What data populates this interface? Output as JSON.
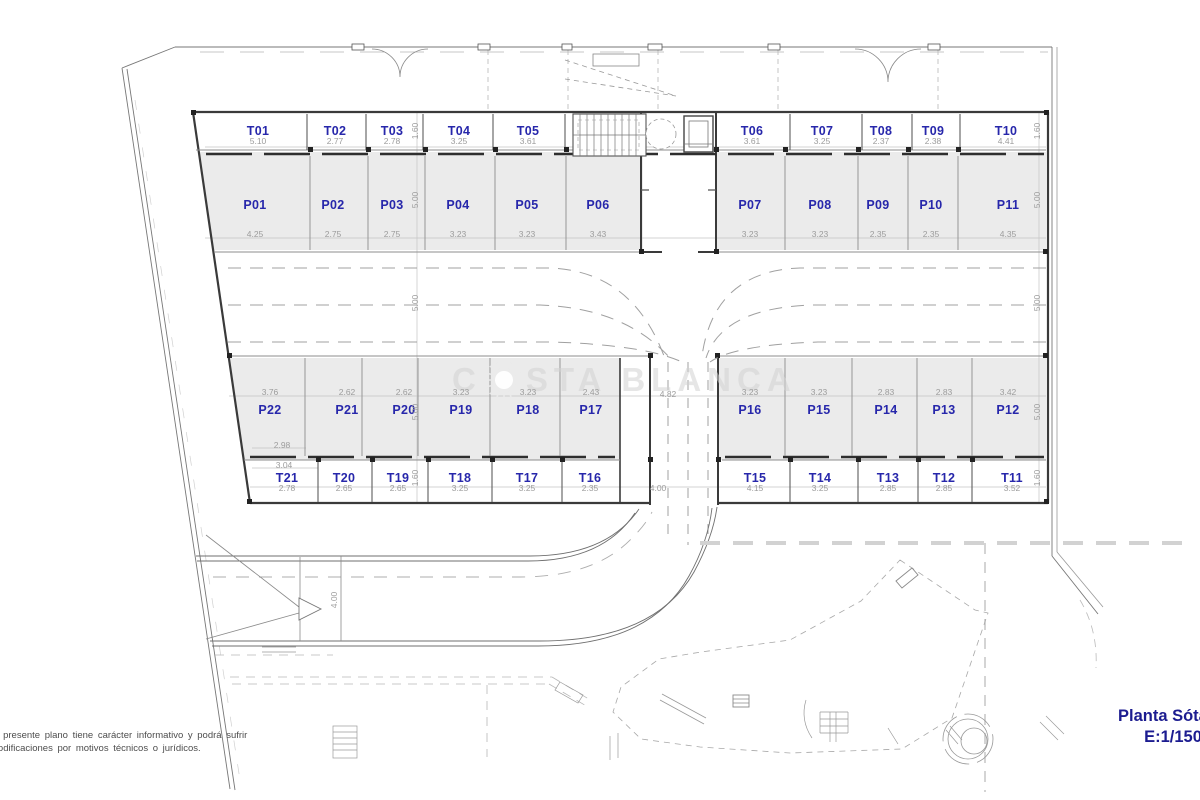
{
  "title_block": {
    "plan_title": "Planta Sótano",
    "scale": "E:1/150"
  },
  "disclaimer": {
    "line1": "El presente plano tiene carácter informativo y podrá sufrir",
    "line2": "modificaciones por motivos técnicos o jurídicos."
  },
  "watermark": {
    "prefix": "C",
    "suffix": "STA BLANCA",
    "sun_icon": "sun-logo"
  },
  "stalls": {
    "storage_top": [
      {
        "id": "T01",
        "w": "5.10"
      },
      {
        "id": "T02",
        "w": "2.77"
      },
      {
        "id": "T03",
        "w": "2.78"
      },
      {
        "id": "T04",
        "w": "3.25"
      },
      {
        "id": "T05",
        "w": "3.61"
      },
      {
        "id": "T06",
        "w": "3.61"
      },
      {
        "id": "T07",
        "w": "3.25"
      },
      {
        "id": "T08",
        "w": "2.37"
      },
      {
        "id": "T09",
        "w": "2.38"
      },
      {
        "id": "T10",
        "w": "4.41"
      }
    ],
    "parking_top": [
      {
        "id": "P01",
        "w": "4.25"
      },
      {
        "id": "P02",
        "w": "2.75"
      },
      {
        "id": "P03",
        "w": "2.75"
      },
      {
        "id": "P04",
        "w": "3.23"
      },
      {
        "id": "P05",
        "w": "3.23"
      },
      {
        "id": "P06",
        "w": "3.43"
      },
      {
        "id": "P07",
        "w": "3.23"
      },
      {
        "id": "P08",
        "w": "3.23"
      },
      {
        "id": "P09",
        "w": "2.35"
      },
      {
        "id": "P10",
        "w": "2.35"
      },
      {
        "id": "P11",
        "w": "4.35"
      }
    ],
    "parking_bottom": [
      {
        "id": "P22",
        "w": "3.76"
      },
      {
        "id": "P21",
        "w": "2.62"
      },
      {
        "id": "P20",
        "w": "2.62"
      },
      {
        "id": "P19",
        "w": "3.23"
      },
      {
        "id": "P18",
        "w": "3.23"
      },
      {
        "id": "P17",
        "w": "2.43"
      },
      {
        "id": "P16",
        "w": "3.23"
      },
      {
        "id": "P15",
        "w": "3.23"
      },
      {
        "id": "P14",
        "w": "2.83"
      },
      {
        "id": "P13",
        "w": "2.83"
      },
      {
        "id": "P12",
        "w": "3.42"
      }
    ],
    "storage_bottom": [
      {
        "id": "T21",
        "w": "2.78"
      },
      {
        "id": "T20",
        "w": "2.65"
      },
      {
        "id": "T19",
        "w": "2.65"
      },
      {
        "id": "T18",
        "w": "3.25"
      },
      {
        "id": "T17",
        "w": "3.25"
      },
      {
        "id": "T16",
        "w": "2.35"
      },
      {
        "id": "T15",
        "w": "4.15"
      },
      {
        "id": "T14",
        "w": "3.25"
      },
      {
        "id": "T13",
        "w": "2.85"
      },
      {
        "id": "T12",
        "w": "2.85"
      },
      {
        "id": "T11",
        "w": "3.52"
      }
    ]
  },
  "dims": {
    "left_chain": [
      "1.60",
      "5.00",
      "5.00",
      "5.00",
      "1.60"
    ],
    "right_chain": [
      "1.60",
      "5.00",
      "5.00",
      "5.00",
      "1.60"
    ],
    "ramp_width": "4.82",
    "ramp_entry": "4.00",
    "road_width": "4.00",
    "p22_inner": "2.98",
    "t21_outer": "3.04"
  },
  "colors": {
    "label": "#2727ab",
    "dimension": "#9c9c9c",
    "title": "#1c1c90",
    "disclaimer": "#4d4d4d",
    "fill": "#ebebeb"
  }
}
